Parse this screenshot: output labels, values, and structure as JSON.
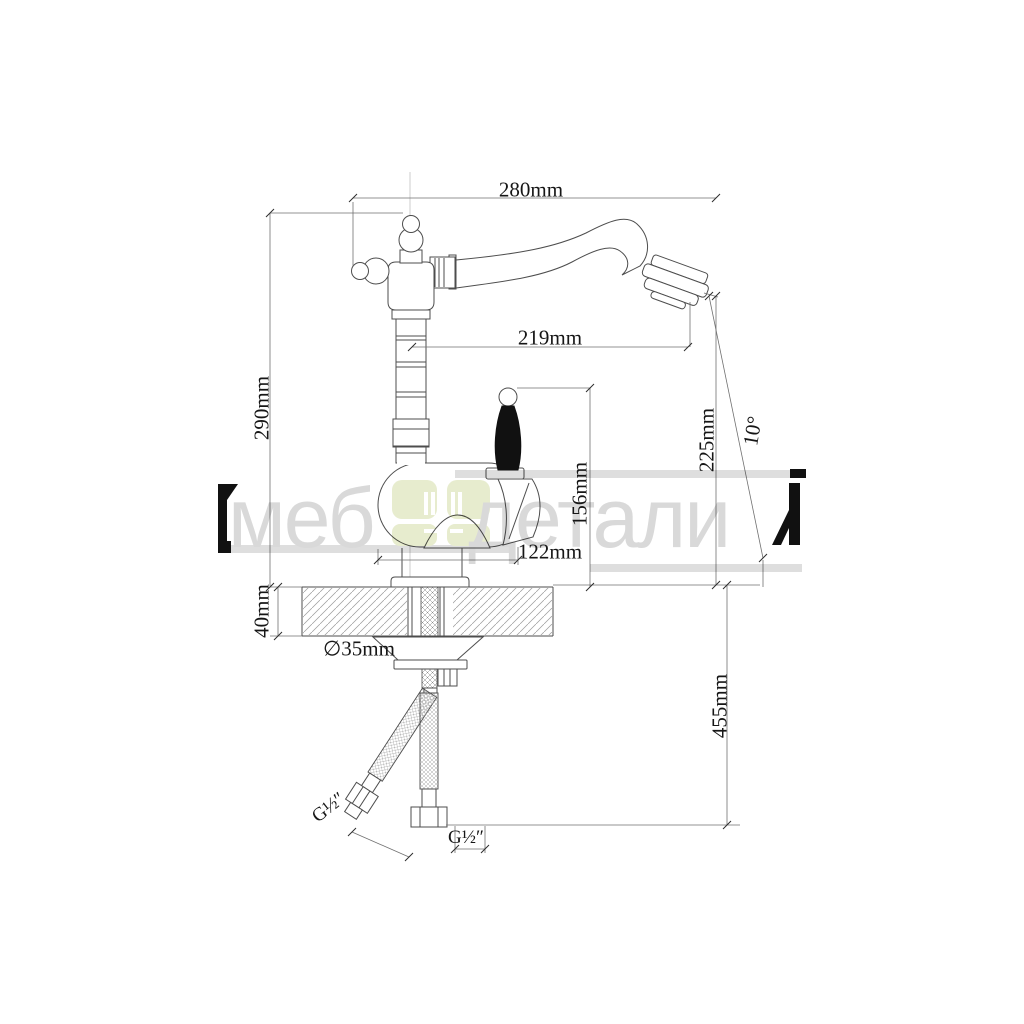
{
  "page": {
    "background": "#ffffff",
    "kind": "product-technical-drawing"
  },
  "drawing": {
    "subject": "kitchen faucet side elevation with installation dimensions"
  },
  "dimensions": {
    "spout_span": "280mm",
    "spout_reach": "219mm",
    "total_height": "290mm",
    "outlet_height": "225mm",
    "spout_angle": "10°",
    "handle_height": "156mm",
    "body_width": "122mm",
    "deck_thickness": "40mm",
    "hole_diameter": "∅35mm",
    "hose_drop": "455mm",
    "thread_left": "G½″",
    "thread_right": "G½″"
  },
  "watermark": {
    "text_left": "меб",
    "text_right": "детали",
    "clipped_letter_left": "М",
    "clipped_letter_right": "Й",
    "logo": "four-pane rounded green square"
  },
  "colors": {
    "line": "#4d4d4d",
    "dimension": "#707070",
    "watermark_gray": "#d9d9d9",
    "band_gray": "#dedede",
    "logo_green": "#e7ecce",
    "black": "#111111",
    "background": "#ffffff"
  }
}
